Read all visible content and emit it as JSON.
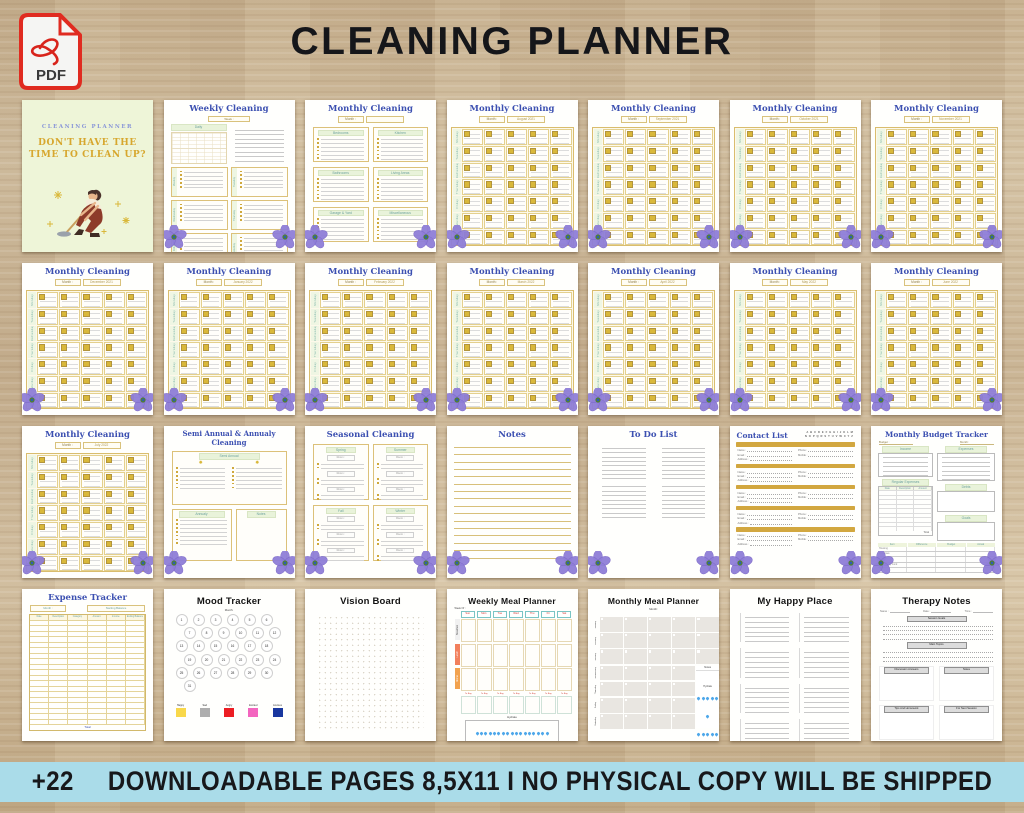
{
  "header": {
    "pdf_label": "PDF",
    "title": "CLEANING PLANNER"
  },
  "footer": {
    "badge": "+22",
    "text": "DOWNLOADABLE PAGES 8,5X11  I  NO PHYSICAL COPY WILL BE SHIPPED"
  },
  "accent_colors": {
    "wood": "#c9b494",
    "footer_blue": "#aadce9",
    "planner_blue": "#3c50b1",
    "gold": "#d2a73f",
    "flower_purple": "#8f7ed8"
  },
  "pages": {
    "cover": {
      "brand": "CLEANING PLANNER",
      "headline1": "DON'T HAVE THE",
      "headline2": "TIME TO CLEAN UP?"
    },
    "weekly": {
      "title": "Weekly Cleaning",
      "week_label": "Week :",
      "daily_label": "Daily",
      "days": [
        "Monday",
        "Tuesday",
        "Wednesday",
        "Thursday",
        "Friday",
        "Saturday"
      ]
    },
    "rooms": {
      "title": "Monthly Cleaning",
      "month_label": "Month :",
      "boxes": [
        "Bedrooms",
        "Kitchen",
        "Bathrooms",
        "Living Areas",
        "Garage & Yard",
        "Miscellaneous"
      ]
    },
    "calendar": {
      "title": "Monthly Cleaning",
      "month_label": "Month :",
      "day_labels": [
        "Monday",
        "Tuesday",
        "Wednesday",
        "Thursday",
        "Friday",
        "Saturday",
        "Sunday"
      ],
      "months": [
        "August 2021",
        "September 2021",
        "October 2021",
        "November 2021",
        "December 2021",
        "January 2022",
        "February 2022",
        "March 2022",
        "April 2022",
        "May 2022",
        "June 2022",
        "July 2022"
      ]
    },
    "semi": {
      "title1": "Semi Annual & Annualy",
      "title2": "Cleaning",
      "semi_label": "Semi Annual",
      "annual_label": "Annualy",
      "notes_label": "Notes"
    },
    "seasonal": {
      "title": "Seasonal Cleaning",
      "room_label": "Room :",
      "seasons": [
        "Spring",
        "Summer",
        "Fall",
        "Winter"
      ]
    },
    "notes": {
      "title": "Notes"
    },
    "todo": {
      "title": "To Do List"
    },
    "contacts": {
      "title": "Contact List",
      "alphabet_row1": "A B C D E F G H I J K L M",
      "alphabet_row2": "N O P Q R S T U V W X Y Z",
      "left_fields": [
        "Name :",
        "Email :",
        "Address :"
      ],
      "right_fields": [
        "Phone :",
        "Mobile :"
      ]
    },
    "budget": {
      "title": "Monthly Budget Tracker",
      "budget_label": "Budget :",
      "month_label": "Month :",
      "income_label": "Income",
      "regular_label": "Regular Expenses",
      "reg_cols": [
        "Date",
        "Description",
        "Amount"
      ],
      "total_label": "Total",
      "expenses_label": "Expenses",
      "debts_label": "Debts",
      "goals_label": "Goals",
      "summary_cols": [
        "Item",
        "Difference",
        "Budget",
        "Actual"
      ],
      "summary_rows": [
        "Housing",
        "Expenses",
        "Savings",
        "Emergency Fund"
      ]
    },
    "expense": {
      "title": "Expense Tracker",
      "month_label": "Month :",
      "balance_label": "Starting Balance",
      "cols": [
        "Date",
        "Description",
        "Category",
        "Amount",
        "Income",
        "Ending Balance"
      ],
      "total_label": "Total"
    },
    "mood": {
      "title": "Mood Tracker",
      "month_label": "Month:",
      "day_count": 31,
      "legend": [
        {
          "label": "Happy",
          "color": "#f9d84a"
        },
        {
          "label": "Sad",
          "color": "#aeaeae"
        },
        {
          "label": "Angry",
          "color": "#ec1d23"
        },
        {
          "label": "Excited",
          "color": "#f365bf"
        },
        {
          "label": "Anxious",
          "color": "#19379f"
        }
      ]
    },
    "vision": {
      "title": "Vision Board"
    },
    "wmeal": {
      "title": "Weekly Meal Planner",
      "week_label": "Week Of :",
      "days": [
        "Sun",
        "Mon",
        "Tue",
        "Wed",
        "Thu",
        "Fri",
        "Sat"
      ],
      "meals": [
        "Breakfast",
        "Lunch",
        "Dinner"
      ],
      "meal_colors": [
        "#f1f1f1",
        "#f2805c",
        "#f2a24e"
      ],
      "tobuy_label": "To Buy",
      "hydrate_label": "Hydrate",
      "cup_label": "Cup Of Water"
    },
    "mmeal": {
      "title": "Monthly Meal Planner",
      "month_label": "Month:",
      "days": [
        "Sunday",
        "Monday",
        "Tuesday",
        "Wednesday",
        "Thursday",
        "Friday",
        "Saturday"
      ],
      "notes_label": "Notes",
      "hydrate_label": "Hydrate",
      "cup_label": "Cup Of Water"
    },
    "happy": {
      "title": "My Happy Place"
    },
    "therapy": {
      "title": "Therapy Notes",
      "fields": [
        "Name :",
        "Date :",
        "Time :"
      ],
      "section1": "Session Goals",
      "section2": "Main Topics",
      "boxes": [
        "Discussion Answers",
        "Notes",
        "Tips And Homework",
        "For Next Session"
      ]
    }
  }
}
